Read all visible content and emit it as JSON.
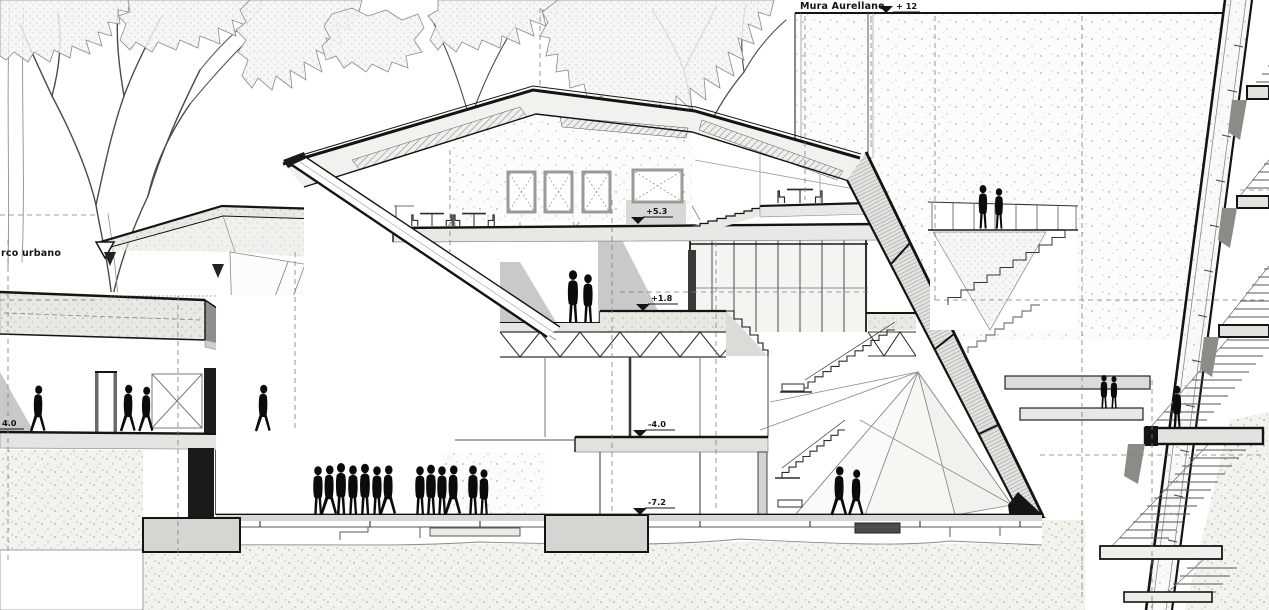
{
  "drawing": {
    "type": "architectural cross-section",
    "scene": "museum section between urban park and Aurelian wall",
    "labels": {
      "wall": "Mura Aurellane",
      "park": "rco urbano"
    },
    "levels": [
      {
        "name": "aurelian-wall-top",
        "label": "+ 12"
      },
      {
        "name": "upper-terrace",
        "label": "+5.3"
      },
      {
        "name": "entrance-level",
        "label": "+1.8"
      },
      {
        "name": "lower-hall",
        "label": "-4.0"
      },
      {
        "name": "basement",
        "label": "-7.2"
      },
      {
        "name": "park-floor",
        "label": "4.0"
      }
    ],
    "colors": {
      "ink": "#161616",
      "line": "#4a4a4a",
      "soft": "#9a9a9a",
      "slab": "#e6e5e1",
      "shadow": "#c9c9c9",
      "silhouette": "#0b0b0b",
      "paper": "#ffffff"
    }
  }
}
